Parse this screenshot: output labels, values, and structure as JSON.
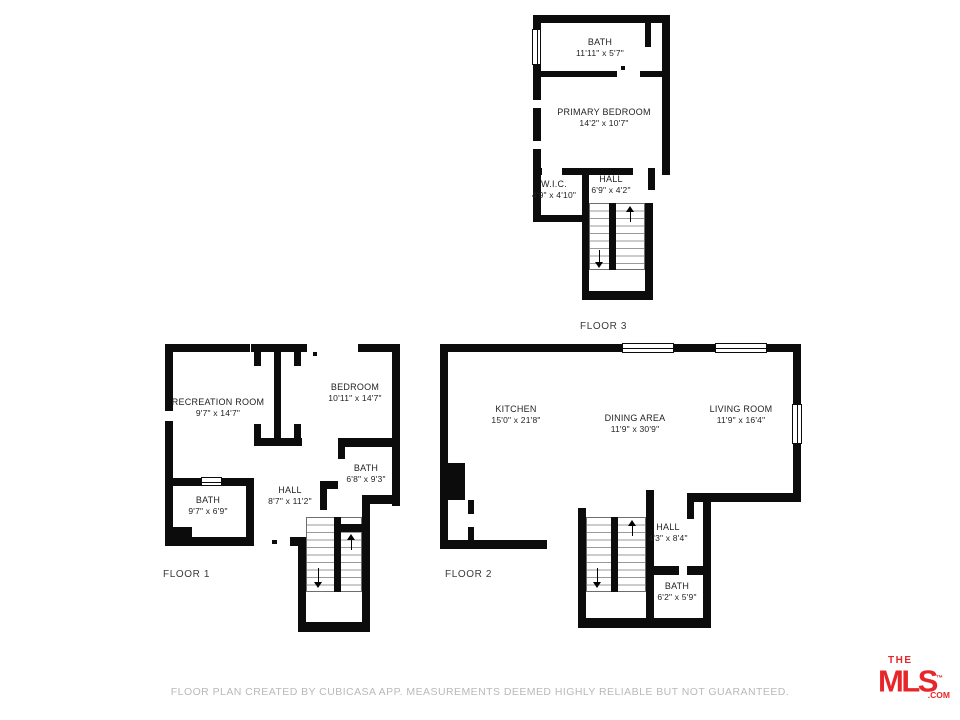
{
  "disclaimer": "FLOOR PLAN CREATED BY CUBICASA APP. MEASUREMENTS DEEMED HIGHLY RELIABLE BUT NOT GUARANTEED.",
  "logo": {
    "the": "THE",
    "mls": "MLS",
    "tm": "™",
    "com": ".COM",
    "color": "#e6262a"
  },
  "wall_color": "#0c0c0c",
  "floor3": {
    "label": "FLOOR 3",
    "rooms": [
      {
        "name": "BATH",
        "dims": "11'11\" x 5'7\""
      },
      {
        "name": "PRIMARY BEDROOM",
        "dims": "14'2\" x 10'7\""
      },
      {
        "name": "W.I.C.",
        "dims": "4'9\" x 4'10\""
      },
      {
        "name": "HALL",
        "dims": "6'9\" x 4'2\""
      }
    ]
  },
  "floor1": {
    "label": "FLOOR 1",
    "rooms": [
      {
        "name": "RECREATION ROOM",
        "dims": "9'7\" x 14'7\""
      },
      {
        "name": "BEDROOM",
        "dims": "10'11\" x 14'7\""
      },
      {
        "name": "BATH",
        "dims": "6'8\" x 9'3\""
      },
      {
        "name": "HALL",
        "dims": "8'7\" x 11'2\""
      },
      {
        "name": "BATH",
        "dims": "9'7\" x 6'9\""
      }
    ]
  },
  "floor2": {
    "label": "FLOOR 2",
    "rooms": [
      {
        "name": "KITCHEN",
        "dims": "15'0\" x 21'8\""
      },
      {
        "name": "DINING AREA",
        "dims": "11'9\" x 30'9\""
      },
      {
        "name": "LIVING ROOM",
        "dims": "11'9\" x 16'4\""
      },
      {
        "name": "HALL",
        "dims": "4'3\" x 8'4\""
      },
      {
        "name": "BATH",
        "dims": "6'2\" x 5'9\""
      }
    ]
  }
}
